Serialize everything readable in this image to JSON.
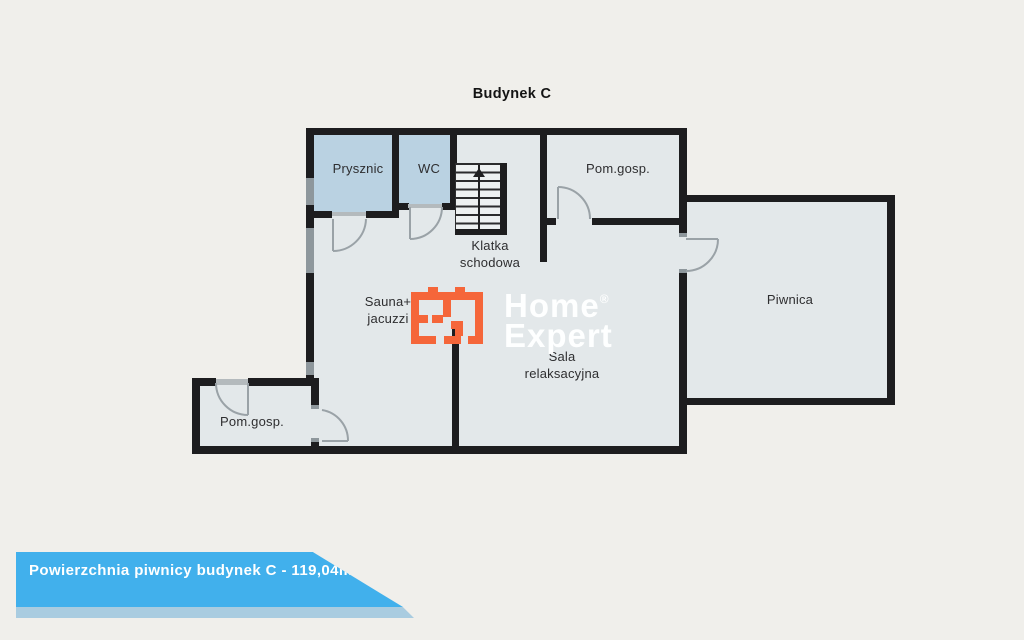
{
  "title": "Budynek C",
  "plan": {
    "rooms": {
      "prysznic": "Prysznic",
      "wc": "WC",
      "klatka_line1": "Klatka",
      "klatka_line2": "schodowa",
      "pom_gosp_top": "Pom.gosp.",
      "sauna_line1": "Sauna+",
      "sauna_line2": "jacuzzi",
      "sala_line1": "Sala",
      "sala_line2": "relaksacyjna",
      "piwnica": "Piwnica",
      "pom_gosp_bottom": "Pom.gosp."
    }
  },
  "logo": {
    "word1": "Home",
    "registered": "®",
    "word2": "Expert"
  },
  "banner": {
    "text": "Powierzchnia piwnicy budynek C - 119,04m2"
  },
  "colors": {
    "background": "#f0efeb",
    "plan_fill": "#e3e8ea",
    "wet_room_blue": "#bad2e2",
    "wall_black": "#1d1d1f",
    "accent_orange": "#f5663a",
    "banner_blue": "#41b0ec",
    "banner_strip_blue": "#a9cce0"
  }
}
